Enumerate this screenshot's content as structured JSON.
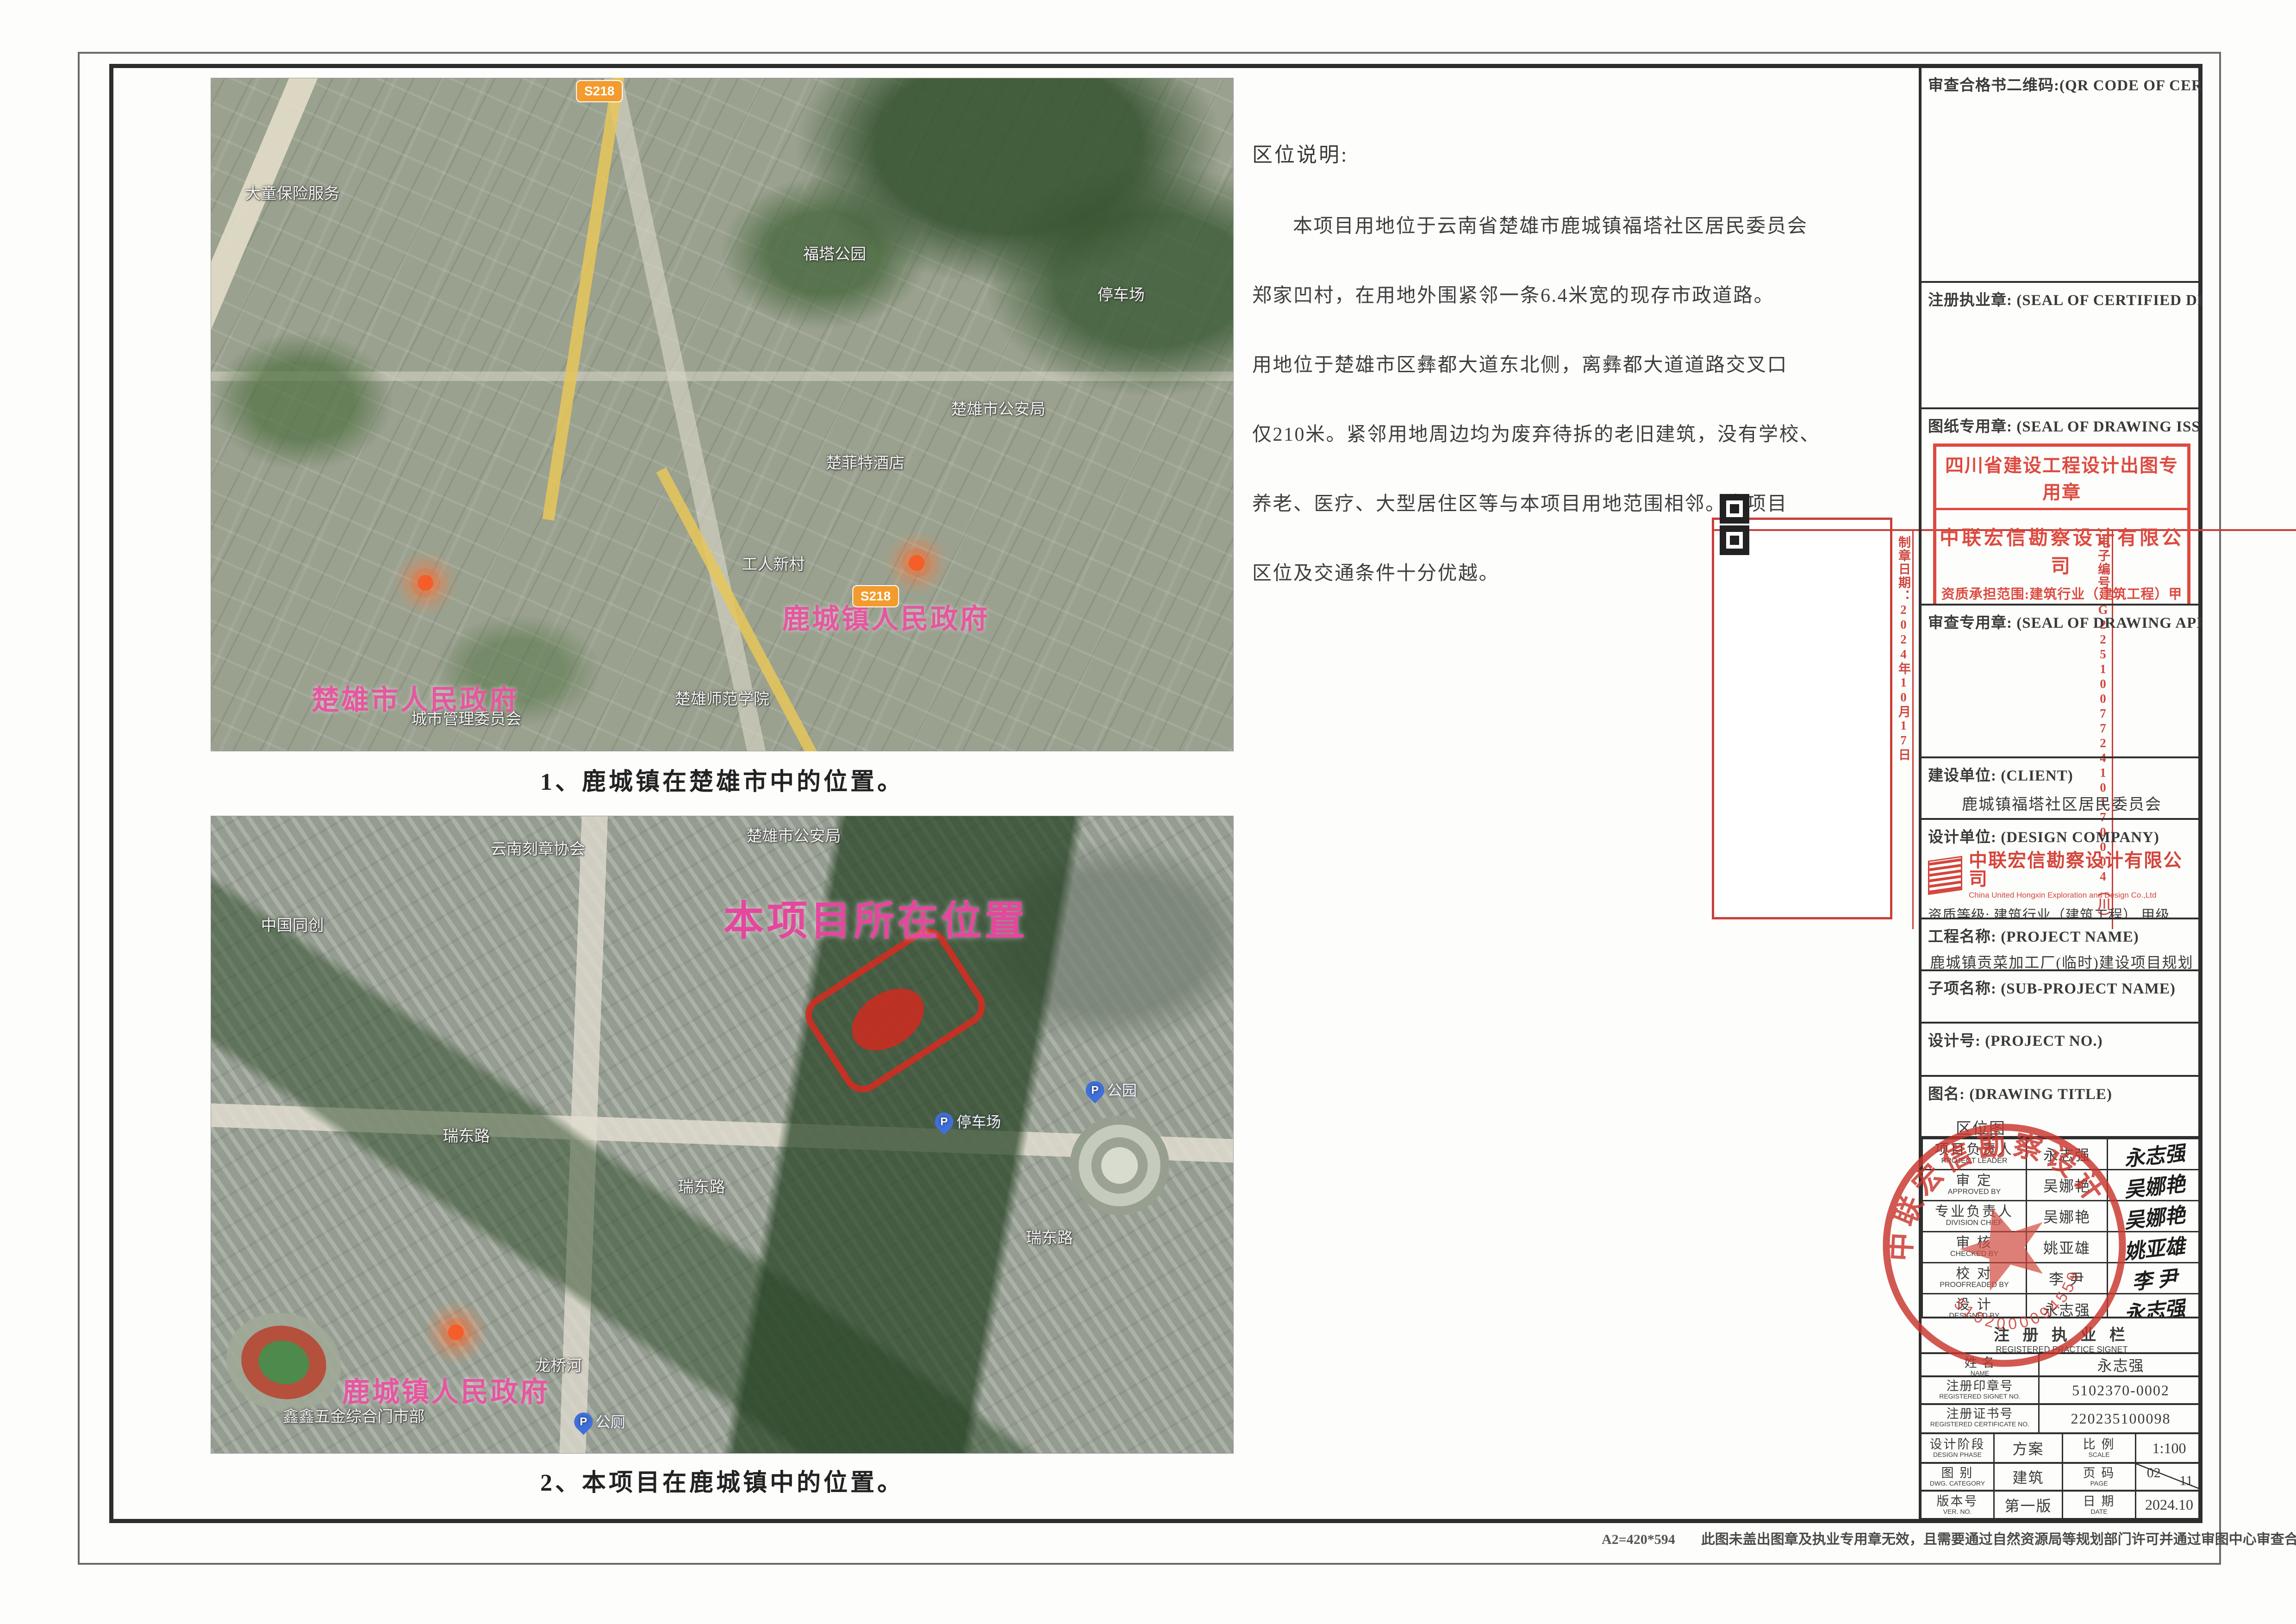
{
  "description": {
    "title": "区位说明:",
    "lines": [
      "本项目用地位于云南省楚雄市鹿城镇福塔社区居民委员会",
      "郑家凹村，在用地外围紧邻一条6.4米宽的现存市政道路。",
      "用地位于楚雄市区彝都大道东北侧，离彝都大道道路交叉口",
      "仅210米。紧邻用地周边均为废弃待拆的老旧建筑，没有学校、",
      "养老、医疗、大型居住区等与本项目用地范围相邻。本项目",
      "区位及交通条件十分优越。"
    ]
  },
  "maps": [
    {
      "caption": "1、鹿城镇在楚雄市中的位置。",
      "labels": [
        {
          "text": "大童保险服务",
          "kind": "poi",
          "x": 8,
          "y": 17
        },
        {
          "text": "福塔公园",
          "kind": "poi",
          "x": 61,
          "y": 26
        },
        {
          "text": "停车场",
          "kind": "poi",
          "x": 89,
          "y": 32
        },
        {
          "text": "楚雄市公安局",
          "kind": "poi",
          "x": 77,
          "y": 49
        },
        {
          "text": "楚菲特酒店",
          "kind": "poi",
          "x": 64,
          "y": 57
        },
        {
          "text": "工人新村",
          "kind": "poi",
          "x": 55,
          "y": 72
        },
        {
          "text": "城市管理委员会",
          "kind": "poi",
          "x": 25,
          "y": 95
        },
        {
          "text": "楚雄师范学院",
          "kind": "poi",
          "x": 50,
          "y": 92
        },
        {
          "text": "楚雄市人民政府",
          "kind": "gov",
          "x": 20,
          "y": 92
        },
        {
          "text": "鹿城镇人民政府",
          "kind": "gov",
          "x": 66,
          "y": 80
        },
        {
          "text": "S218",
          "kind": "badge",
          "x": 38,
          "y": 2
        },
        {
          "text": "S218",
          "kind": "badge",
          "x": 65,
          "y": 77
        }
      ],
      "markers": [
        {
          "x": 21,
          "y": 75
        },
        {
          "x": 69,
          "y": 72
        }
      ]
    },
    {
      "caption": "2、本项目在鹿城镇中的位置。",
      "labels": [
        {
          "text": "楚雄市公安局",
          "kind": "poi",
          "x": 57,
          "y": 3
        },
        {
          "text": "云南刻章协会",
          "kind": "poi",
          "x": 32,
          "y": 5
        },
        {
          "text": "中国同创",
          "kind": "poi",
          "x": 8,
          "y": 17
        },
        {
          "text": "瑞东路",
          "kind": "poi",
          "x": 25,
          "y": 50
        },
        {
          "text": "瑞东路",
          "kind": "poi",
          "x": 48,
          "y": 58
        },
        {
          "text": "瑞东路",
          "kind": "poi",
          "x": 82,
          "y": 66
        },
        {
          "text": "停车场",
          "kind": "pin",
          "x": 74,
          "y": 48
        },
        {
          "text": "公园",
          "kind": "pin",
          "x": 88,
          "y": 43
        },
        {
          "text": "龙桥河",
          "kind": "poi",
          "x": 34,
          "y": 86
        },
        {
          "text": "鑫鑫五金综合门市部",
          "kind": "poi",
          "x": 14,
          "y": 94
        },
        {
          "text": "公厕",
          "kind": "pin",
          "x": 38,
          "y": 95
        },
        {
          "text": "本项目所在位置",
          "kind": "site",
          "x": 65,
          "y": 16
        },
        {
          "text": "鹿城镇人民政府",
          "kind": "gov",
          "x": 23,
          "y": 90
        }
      ],
      "markers": [
        {
          "x": 24,
          "y": 81
        }
      ]
    }
  ],
  "qr": {
    "side_title": "云南省国土空间规划成果二维码",
    "columns": [
      "项目名称：鹿城镇贡菜加工厂（临时）建设项目规划设计方案",
      "编制单位：中联宏信勘察设计有限公司",
      "电子编号：G225100772410170004（川）",
      "制章日期：2024年10月17日"
    ]
  },
  "tb": {
    "qr_cert": {
      "label": "审查合格书二维码:(QR CODE OF CERTIFICATION)"
    },
    "designer": {
      "label": "注册执业章:  (SEAL OF CERTIFIED DESIGNER)"
    },
    "drawseal": {
      "label": "图纸专用章:  (SEAL OF DRAWING ISSUEE)",
      "stamp": {
        "title": "四川省建设工程设计出图专用章",
        "company": "中联宏信勘察设计有限公司",
        "scope": "资质承担范围:建筑行业（建筑工程）甲级",
        "footer": "编号:A151023703　有效期至:2026年06月04日"
      }
    },
    "approval": {
      "label": "审查专用章:  (SEAL OF DRAWING APPROVAL)"
    },
    "client": {
      "label": "建设单位:  (CLIENT)",
      "value": "鹿城镇福塔社区居民委员会"
    },
    "company": {
      "label": "设计单位:  (DESIGN COMPANY)",
      "logo_cn": "中联宏信勘察设计有限公司",
      "logo_en": "China United Hongxin Exploration and Design Co.,Ltd",
      "grade": "资质等级: 建筑行业（建筑工程） 甲级",
      "cert": "证书编号: A151023703"
    },
    "projname": {
      "label": "工程名称:  (PROJECT NAME)",
      "value": "鹿城镇贡菜加工厂(临时)建设项目规划设计方案"
    },
    "subproj": {
      "label": "子项名称:  (SUB-PROJECT NAME)"
    },
    "projno": {
      "label": "设计号:  (PROJECT NO.)"
    },
    "drawtitle": {
      "label": "图名:  (DRAWING TITLE)",
      "value": "区位图"
    },
    "signatures": [
      {
        "role": "项目负责人",
        "role_en": "PROJECT LEADER",
        "name": "永志强"
      },
      {
        "role": "审  定",
        "role_en": "APPROVED BY",
        "name": "吴娜艳"
      },
      {
        "role": "专业负责人",
        "role_en": "DIVISION CHIEF",
        "name": "吴娜艳"
      },
      {
        "role": "审  核",
        "role_en": "CHECKED BY",
        "name": "姚亚雄"
      },
      {
        "role": "校  对",
        "role_en": "PROOFREADED BY",
        "name": "李 尹"
      },
      {
        "role": "设  计",
        "role_en": "DESIGNED BY",
        "name": "永志强"
      }
    ],
    "reg_header": {
      "cn": "注 册 执 业 栏",
      "en": "REGISTERED PRACTICE SIGNET"
    },
    "reg_rows": [
      {
        "label": "姓  名",
        "label_en": "NAME",
        "value": "永志强",
        "h": "row-h50"
      },
      {
        "label": "注册印章号",
        "label_en": "REGISTERED SIGNET NO.",
        "value": "5102370-0002",
        "h": "row-h60"
      },
      {
        "label": "注册证书号",
        "label_en": "REGISTERED CERTIFICATE NO.",
        "value": "220235100098",
        "h": "row-h63"
      }
    ],
    "grid_rows": [
      {
        "l": "设计阶段",
        "l_en": "DESIGN PHASE",
        "v": "方案",
        "l2": "比  例",
        "l2_en": "SCALE",
        "v2": "1:100",
        "h": "row-h64"
      },
      {
        "l": "图  别",
        "l_en": "DWG. CATEGORY",
        "v": "建筑",
        "l2": "页  码",
        "l2_en": "PAGE",
        "v2a": "02",
        "v2b": "11",
        "h": "row-h60"
      },
      {
        "l": "版本号",
        "l_en": "VER.  NO.",
        "v": "第一版",
        "l2": "日  期",
        "l2_en": "DATE",
        "v2": "2024.10",
        "h": "row-h61"
      }
    ]
  },
  "round_seal": {
    "arc_text": "中联宏信勘察设计有限公司",
    "number": "5102000094559"
  },
  "footer": {
    "paper": "A2=420*594",
    "disclaimer": "此图未盖出图章及执业专用章无效，且需要通过自然资源局等规划部门许可并通过审图中心审查合格后方可实施"
  },
  "colors": {
    "stamp_red": "#dd4a40",
    "seal_red": "#c9362e",
    "pink_label": "#e557a0",
    "badge_orange": "#f39b2d"
  }
}
